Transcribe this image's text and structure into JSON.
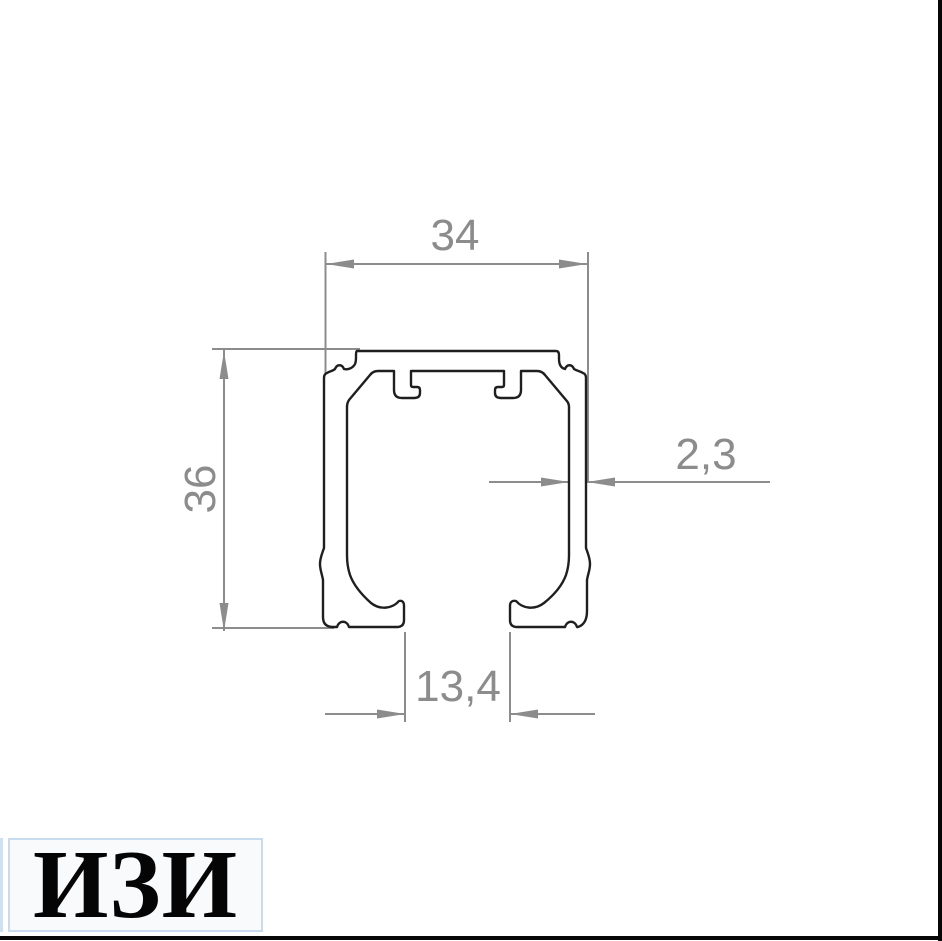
{
  "drawing": {
    "kind": "aluminium profile cross-section",
    "dim_top_width": "34",
    "dim_left_height": "36",
    "dim_wall_thickness": "2,3",
    "dim_bottom_opening": "13,4",
    "outline_color": "#1f1f1f",
    "dimension_color": "#8c8c8c",
    "background_color": "#ffffff"
  },
  "logo": {
    "text": "ИЗИ"
  }
}
